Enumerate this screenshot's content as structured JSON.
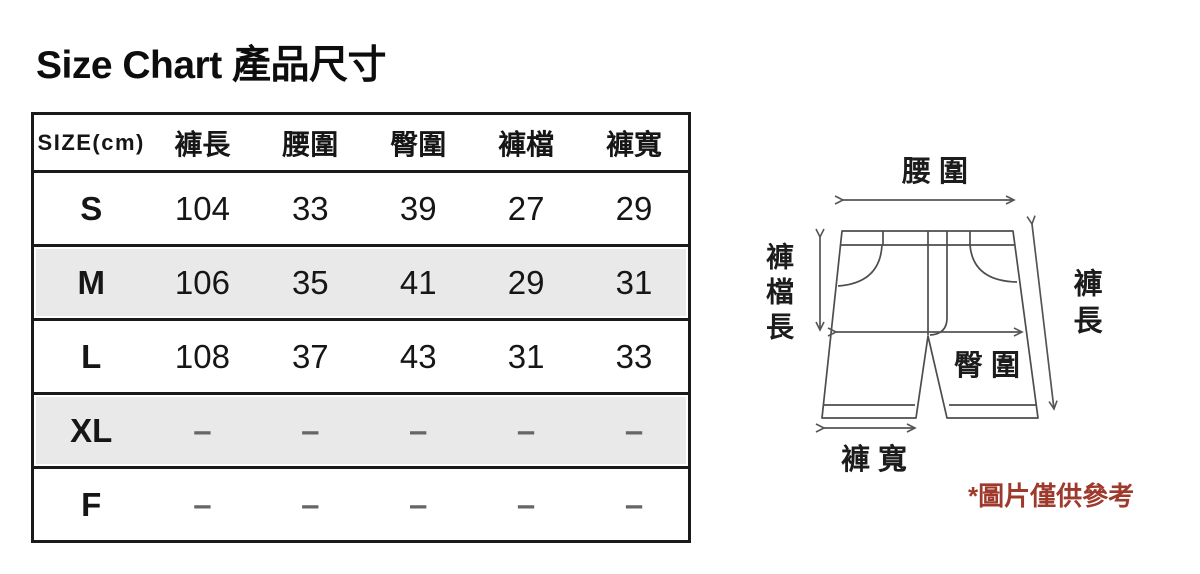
{
  "title": "Size Chart 產品尺寸",
  "table": {
    "headers": [
      "SIZE(cm)",
      "褲長",
      "腰圍",
      "臀圍",
      "褲檔",
      "褲寬"
    ],
    "rows": [
      {
        "size": "S",
        "values": [
          "104",
          "33",
          "39",
          "27",
          "29"
        ]
      },
      {
        "size": "M",
        "values": [
          "106",
          "35",
          "41",
          "29",
          "31"
        ]
      },
      {
        "size": "L",
        "values": [
          "108",
          "37",
          "43",
          "31",
          "33"
        ]
      },
      {
        "size": "XL",
        "values": [
          "–",
          "–",
          "–",
          "–",
          "–"
        ]
      },
      {
        "size": "F",
        "values": [
          "–",
          "–",
          "–",
          "–",
          "–"
        ]
      }
    ]
  },
  "diagram": {
    "labels": {
      "waist": "腰 圍",
      "crotch_length": "褲檔長",
      "pants_length": "褲長",
      "hip": "臀 圍",
      "pants_width": "褲 寬"
    },
    "note": "*圖片僅供參考"
  },
  "colors": {
    "note_red": "#9e3a2c",
    "shaded_row": "#e9e9e9",
    "table_border": "#1a1a1a",
    "diagram_line": "#555555"
  }
}
